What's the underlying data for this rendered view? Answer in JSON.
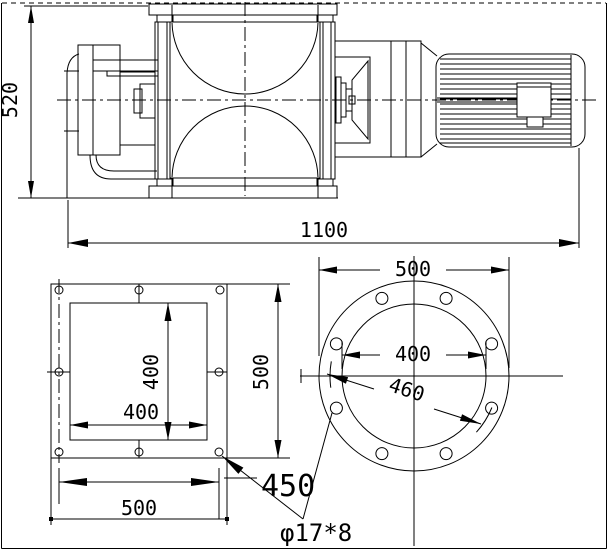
{
  "colors": {
    "line": "#000000",
    "background": "#ffffff"
  },
  "front_view": {
    "overall_height": "520",
    "overall_length": "1100"
  },
  "square_flange_view": {
    "opening_height": "400",
    "opening_width": "400",
    "overall_height": "500",
    "overall_width": "500",
    "bolt_spacing": "450"
  },
  "round_flange_view": {
    "flange_od": "500",
    "bore_dia": "400",
    "bolt_circle_dia": "460"
  },
  "notes": {
    "hole_spec": "φ17*8"
  }
}
